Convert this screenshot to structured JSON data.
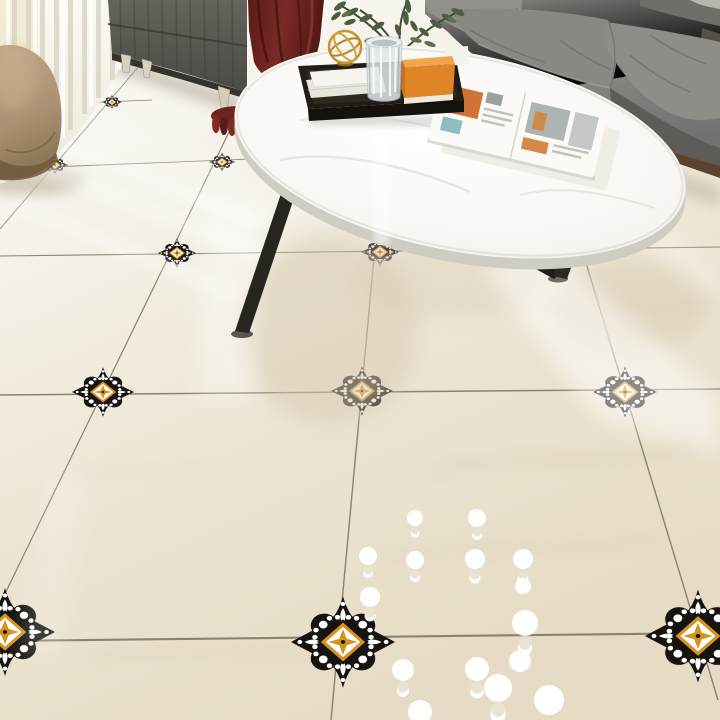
{
  "scene": {
    "description": "Glossy cream marble tile floor with ornamental black-gold corner decal stickers, white oval marble coffee table with black metal legs, grey fabric sofa, grey ottoman, tan bean-bag pouf, sheer white curtain, dark red drape, green plant, decor tray",
    "palette": {
      "floor_top": "#fcfbf8",
      "floor_mid": "#f1ecdf",
      "floor_bottom": "#e6ddc7",
      "grout": "#8a8171",
      "med_black": "#17140f",
      "med_orange": "#d8931f",
      "med_white": "#ffffff",
      "sofa": "#8b8883",
      "sofa_dark": "#6b6863",
      "ottoman": "#59584f",
      "pouf": "#b29878",
      "curtain": "#f8f5ec",
      "drape_red": "#6e2421",
      "plant_green": "#4c5e41",
      "table_white": "#fdfcfa",
      "tray_black": "#211d16",
      "box_orange": "#e08428",
      "orb_gold": "#c6942f",
      "shadow_beige": "#d7cab2",
      "reflection_white": "#ffffff"
    },
    "floor": {
      "grout_rows": [
        {
          "x1": 55,
          "y1": 104,
          "x2": 152,
          "y2": 100,
          "w": 0.7
        },
        {
          "x1": 0,
          "y1": 169,
          "x2": 300,
          "y2": 157,
          "w": 0.9
        },
        {
          "x1": 0,
          "y1": 256,
          "x2": 720,
          "y2": 247,
          "w": 1.1
        },
        {
          "x1": 0,
          "y1": 395,
          "x2": 720,
          "y2": 389,
          "w": 1.5
        },
        {
          "x1": 0,
          "y1": 641,
          "x2": 720,
          "y2": 633,
          "w": 2.1
        }
      ],
      "grout_cols": [
        {
          "x1": 140,
          "y1": 65,
          "x2": 0,
          "y2": 229,
          "w": 0.8
        },
        {
          "x1": 230,
          "y1": 130,
          "x2": 0,
          "y2": 604,
          "w": 1.2
        },
        {
          "x1": 375,
          "y1": 247,
          "x2": 331,
          "y2": 720,
          "w": 1.4
        },
        {
          "x1": 570,
          "y1": 210,
          "x2": 718,
          "y2": 700,
          "w": 1.4
        }
      ],
      "medallions": [
        {
          "x": 112,
          "y": 102,
          "s": 0.2,
          "sy": 0.75
        },
        {
          "x": 55,
          "y": 165,
          "s": 0.26,
          "sy": 0.75
        },
        {
          "x": 222,
          "y": 162,
          "s": 0.26,
          "sy": 0.75
        },
        {
          "x": 177,
          "y": 253,
          "s": 0.38,
          "sy": 0.76
        },
        {
          "x": 380,
          "y": 252,
          "s": 0.38,
          "sy": 0.76
        },
        {
          "x": 583,
          "y": 252,
          "s": 0.38,
          "sy": 0.76
        },
        {
          "x": 103,
          "y": 392,
          "s": 0.62,
          "sy": 0.8
        },
        {
          "x": 362,
          "y": 391,
          "s": 0.62,
          "sy": 0.8
        },
        {
          "x": 625,
          "y": 392,
          "s": 0.64,
          "sy": 0.8
        },
        {
          "x": 5,
          "y": 632,
          "s": 1.0,
          "sy": 0.88
        },
        {
          "x": 343,
          "y": 642,
          "s": 1.04,
          "sy": 0.88
        },
        {
          "x": 698,
          "y": 636,
          "s": 1.06,
          "sy": 0.88
        }
      ],
      "light_dots": [
        {
          "x": 415,
          "y": 518,
          "r": 8,
          "hook": true
        },
        {
          "x": 477,
          "y": 518,
          "r": 9,
          "hook": true
        },
        {
          "x": 368,
          "y": 556,
          "r": 9,
          "hook": true
        },
        {
          "x": 415,
          "y": 560,
          "r": 9,
          "hook": true
        },
        {
          "x": 475,
          "y": 559,
          "r": 10,
          "hook": true
        },
        {
          "x": 523,
          "y": 559,
          "r": 10,
          "hook": true
        },
        {
          "x": 370,
          "y": 597,
          "r": 10,
          "hook": true
        },
        {
          "x": 523,
          "y": 586,
          "r": 8,
          "hook": false
        },
        {
          "x": 525,
          "y": 623,
          "r": 13,
          "hook": true
        },
        {
          "x": 403,
          "y": 670,
          "r": 11,
          "hook": true
        },
        {
          "x": 477,
          "y": 669,
          "r": 12,
          "hook": true
        },
        {
          "x": 520,
          "y": 661,
          "r": 11,
          "hook": false
        },
        {
          "x": 498,
          "y": 688,
          "r": 14,
          "hook": true
        },
        {
          "x": 549,
          "y": 700,
          "r": 15,
          "hook": false
        },
        {
          "x": 420,
          "y": 712,
          "r": 12,
          "hook": false
        }
      ]
    },
    "objects": [
      "sheer-curtain",
      "bean-bag-pouf",
      "grey-ottoman",
      "red-drape",
      "green-plant",
      "grey-sofa",
      "coffee-table",
      "black-tray",
      "white-books",
      "gold-wire-orb",
      "glass-vase",
      "orange-box",
      "open-magazines",
      "tile-medallion-stickers"
    ]
  }
}
